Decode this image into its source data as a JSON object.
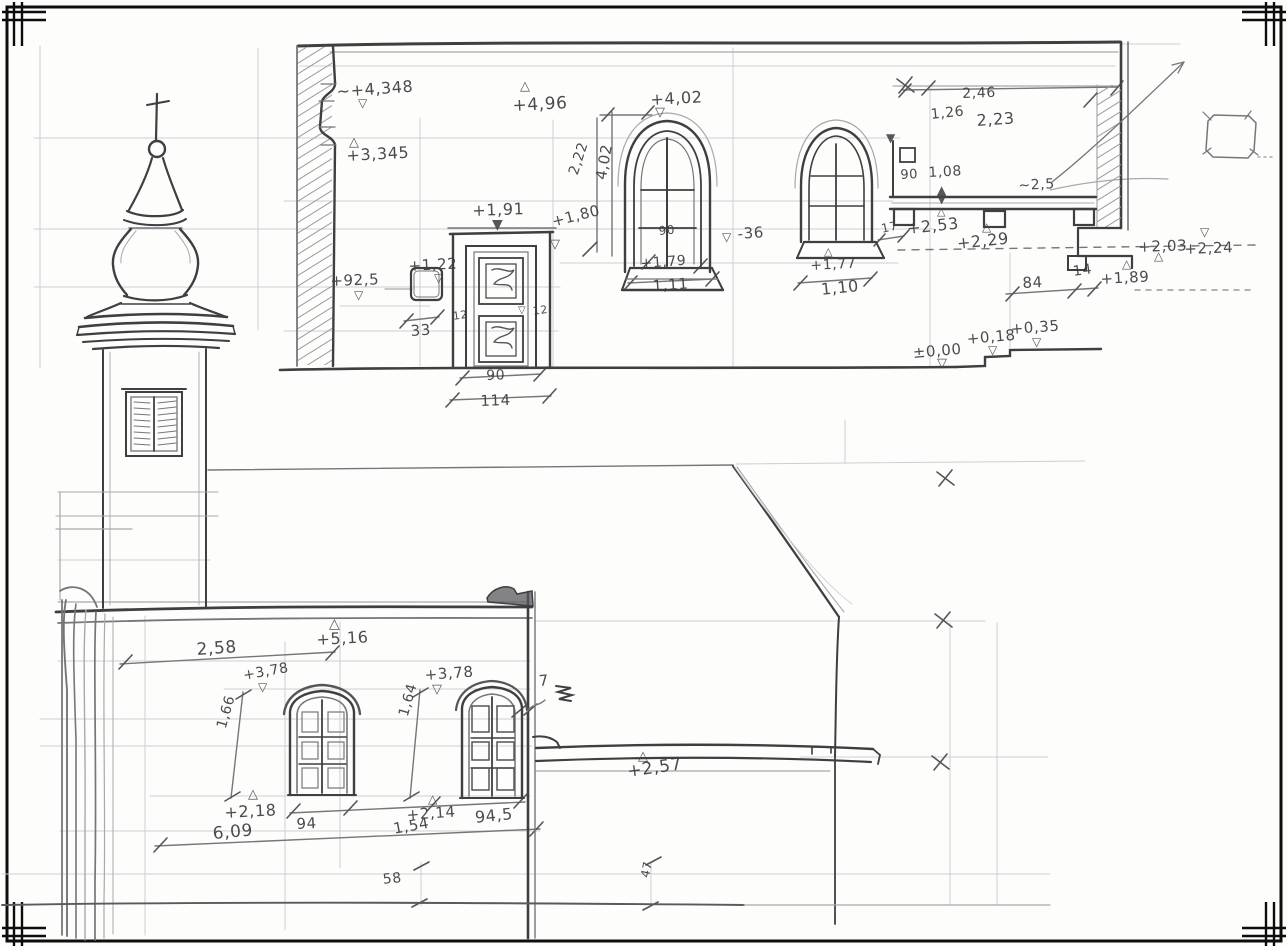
{
  "meta": {
    "sheet_type": "hand-drawn architectural survey field sketch",
    "subject": "church elevations: upper street facade with paneled door and two arched windows, baroque onion-dome tower, lower courtyard facade with two arched windows",
    "medium": "pencil on white paper",
    "paper_color": "#fdfdfc",
    "pencil_color": "#3f3f41",
    "marker_note": "triangles mark surveyed spot levels; values use comma decimals (metres) and plain centimetre figures"
  },
  "annotations": {
    "upper": [
      {
        "text": "~+4,348",
        "x": 336,
        "y": 82,
        "rot": -4,
        "fs": 16,
        "role": "level"
      },
      {
        "text": "+4,96",
        "x": 512,
        "y": 96,
        "rot": -3,
        "fs": 17,
        "role": "level"
      },
      {
        "text": "+3,345",
        "x": 346,
        "y": 146,
        "rot": -3,
        "fs": 16,
        "role": "level"
      },
      {
        "text": "+1,91",
        "x": 472,
        "y": 201,
        "rot": -2,
        "fs": 16,
        "role": "level"
      },
      {
        "text": "+1,80",
        "x": 550,
        "y": 213,
        "rot": -14,
        "fs": 15,
        "role": "level"
      },
      {
        "text": "2,22",
        "x": 566,
        "y": 172,
        "rot": -72,
        "fs": 14,
        "role": "dim"
      },
      {
        "text": "4,02",
        "x": 592,
        "y": 178,
        "rot": -80,
        "fs": 15,
        "role": "dim"
      },
      {
        "text": "+4,02",
        "x": 650,
        "y": 90,
        "rot": -3,
        "fs": 16,
        "role": "level"
      },
      {
        "text": "90",
        "x": 658,
        "y": 224,
        "rot": -5,
        "fs": 12,
        "role": "dim"
      },
      {
        "text": "+1,79",
        "x": 640,
        "y": 256,
        "rot": -4,
        "fs": 14,
        "role": "level"
      },
      {
        "text": "1,11",
        "x": 652,
        "y": 277,
        "rot": -4,
        "fs": 15,
        "role": "dim"
      },
      {
        "text": "-36",
        "x": 737,
        "y": 225,
        "rot": -4,
        "fs": 15,
        "role": "level"
      },
      {
        "text": "+1,77",
        "x": 810,
        "y": 258,
        "rot": -3,
        "fs": 14,
        "role": "level"
      },
      {
        "text": "1,10",
        "x": 820,
        "y": 280,
        "rot": -6,
        "fs": 16,
        "role": "dim"
      },
      {
        "text": "17",
        "x": 880,
        "y": 222,
        "rot": -12,
        "fs": 12,
        "role": "dim"
      },
      {
        "text": "2,46",
        "x": 962,
        "y": 86,
        "rot": -2,
        "fs": 14,
        "role": "dim"
      },
      {
        "text": "1,26",
        "x": 930,
        "y": 107,
        "rot": -6,
        "fs": 14,
        "role": "dim"
      },
      {
        "text": "2,23",
        "x": 976,
        "y": 111,
        "rot": -4,
        "fs": 16,
        "role": "dim"
      },
      {
        "text": "90",
        "x": 900,
        "y": 168,
        "rot": -3,
        "fs": 13,
        "role": "dim"
      },
      {
        "text": "1,08",
        "x": 928,
        "y": 165,
        "rot": -3,
        "fs": 14,
        "role": "dim"
      },
      {
        "text": "~2,5",
        "x": 1018,
        "y": 178,
        "rot": -3,
        "fs": 14,
        "role": "dim"
      },
      {
        "text": "+2,53",
        "x": 906,
        "y": 219,
        "rot": -6,
        "fs": 16,
        "role": "level"
      },
      {
        "text": "+2,29",
        "x": 956,
        "y": 234,
        "rot": -6,
        "fs": 16,
        "role": "level"
      },
      {
        "text": "84",
        "x": 1022,
        "y": 274,
        "rot": -3,
        "fs": 15,
        "role": "dim"
      },
      {
        "text": "14",
        "x": 1072,
        "y": 264,
        "rot": -8,
        "fs": 14,
        "role": "dim"
      },
      {
        "text": "+1,89",
        "x": 1100,
        "y": 270,
        "rot": -3,
        "fs": 15,
        "role": "level"
      },
      {
        "text": "+2,03",
        "x": 1138,
        "y": 238,
        "rot": -2,
        "fs": 15,
        "role": "level"
      },
      {
        "text": "+2,24",
        "x": 1184,
        "y": 240,
        "rot": -2,
        "fs": 15,
        "role": "level"
      },
      {
        "text": "±0,00",
        "x": 912,
        "y": 344,
        "rot": -5,
        "fs": 15,
        "role": "level"
      },
      {
        "text": "+0,18",
        "x": 966,
        "y": 330,
        "rot": -5,
        "fs": 15,
        "role": "level"
      },
      {
        "text": "+0,35",
        "x": 1010,
        "y": 320,
        "rot": -4,
        "fs": 15,
        "role": "level"
      },
      {
        "text": "+92,5",
        "x": 330,
        "y": 272,
        "rot": -2,
        "fs": 15,
        "role": "level"
      },
      {
        "text": "+1,22",
        "x": 408,
        "y": 257,
        "rot": -3,
        "fs": 15,
        "role": "level"
      },
      {
        "text": "33",
        "x": 410,
        "y": 322,
        "rot": -4,
        "fs": 15,
        "role": "dim"
      },
      {
        "text": "12",
        "x": 452,
        "y": 310,
        "rot": -8,
        "fs": 11,
        "role": "dim"
      },
      {
        "text": "12",
        "x": 532,
        "y": 305,
        "rot": -8,
        "fs": 11,
        "role": "dim"
      },
      {
        "text": "90",
        "x": 486,
        "y": 368,
        "rot": -2,
        "fs": 14,
        "role": "dim"
      },
      {
        "text": "114",
        "x": 480,
        "y": 392,
        "rot": -2,
        "fs": 15,
        "role": "dim"
      }
    ],
    "lower": [
      {
        "text": "+5,16",
        "x": 316,
        "y": 630,
        "rot": -3,
        "fs": 16,
        "role": "level"
      },
      {
        "text": "2,58",
        "x": 196,
        "y": 640,
        "rot": -4,
        "fs": 17,
        "role": "dim"
      },
      {
        "text": "+3,78",
        "x": 242,
        "y": 668,
        "rot": -10,
        "fs": 14,
        "role": "level"
      },
      {
        "text": "1,66",
        "x": 214,
        "y": 726,
        "rot": -74,
        "fs": 14,
        "role": "dim"
      },
      {
        "text": "+2,18",
        "x": 224,
        "y": 803,
        "rot": -3,
        "fs": 16,
        "role": "level"
      },
      {
        "text": "94",
        "x": 296,
        "y": 815,
        "rot": -3,
        "fs": 15,
        "role": "dim"
      },
      {
        "text": "6,09",
        "x": 212,
        "y": 824,
        "rot": -5,
        "fs": 17,
        "role": "dim"
      },
      {
        "text": "+3,78",
        "x": 424,
        "y": 666,
        "rot": -4,
        "fs": 15,
        "role": "level"
      },
      {
        "text": "1,64",
        "x": 396,
        "y": 714,
        "rot": -74,
        "fs": 14,
        "role": "dim"
      },
      {
        "text": "7",
        "x": 538,
        "y": 672,
        "rot": -5,
        "fs": 15,
        "role": "dim"
      },
      {
        "text": "+2,14",
        "x": 406,
        "y": 806,
        "rot": -4,
        "fs": 15,
        "role": "level"
      },
      {
        "text": "1,54",
        "x": 392,
        "y": 820,
        "rot": -10,
        "fs": 15,
        "role": "dim"
      },
      {
        "text": "94,5",
        "x": 474,
        "y": 808,
        "rot": -6,
        "fs": 16,
        "role": "dim"
      },
      {
        "text": "+2,57",
        "x": 626,
        "y": 762,
        "rot": -8,
        "fs": 17,
        "role": "level"
      },
      {
        "text": "58",
        "x": 382,
        "y": 872,
        "rot": -6,
        "fs": 14,
        "role": "dim"
      },
      {
        "text": "47",
        "x": 638,
        "y": 876,
        "rot": -78,
        "fs": 12,
        "role": "dim"
      }
    ],
    "markers": [
      {
        "glyph": "▽",
        "x": 358,
        "y": 97,
        "fs": 12
      },
      {
        "glyph": "△",
        "x": 520,
        "y": 80,
        "fs": 13
      },
      {
        "glyph": "△",
        "x": 349,
        "y": 136,
        "fs": 13
      },
      {
        "glyph": "▼",
        "x": 492,
        "y": 218,
        "fs": 14
      },
      {
        "glyph": "▽",
        "x": 550,
        "y": 238,
        "fs": 13
      },
      {
        "glyph": "▽",
        "x": 655,
        "y": 106,
        "fs": 13
      },
      {
        "glyph": "▽",
        "x": 722,
        "y": 231,
        "fs": 12
      },
      {
        "glyph": "△",
        "x": 824,
        "y": 246,
        "fs": 11
      },
      {
        "glyph": "▼",
        "x": 886,
        "y": 132,
        "fs": 12
      },
      {
        "glyph": "▲",
        "x": 937,
        "y": 184,
        "fs": 12
      },
      {
        "glyph": "▼",
        "x": 937,
        "y": 193,
        "fs": 12
      },
      {
        "glyph": "△",
        "x": 937,
        "y": 206,
        "fs": 11
      },
      {
        "glyph": "△",
        "x": 982,
        "y": 221,
        "fs": 12
      },
      {
        "glyph": "△",
        "x": 1122,
        "y": 258,
        "fs": 12
      },
      {
        "glyph": "△",
        "x": 1154,
        "y": 250,
        "fs": 12
      },
      {
        "glyph": "▽",
        "x": 1200,
        "y": 226,
        "fs": 12
      },
      {
        "glyph": "▽",
        "x": 937,
        "y": 357,
        "fs": 13
      },
      {
        "glyph": "▽",
        "x": 988,
        "y": 344,
        "fs": 12
      },
      {
        "glyph": "▽",
        "x": 1032,
        "y": 336,
        "fs": 12
      },
      {
        "glyph": "▽",
        "x": 354,
        "y": 289,
        "fs": 12
      },
      {
        "glyph": "▽",
        "x": 434,
        "y": 272,
        "fs": 12
      },
      {
        "glyph": "▽",
        "x": 518,
        "y": 306,
        "fs": 10
      },
      {
        "glyph": "△",
        "x": 329,
        "y": 617,
        "fs": 14
      },
      {
        "glyph": "▽",
        "x": 258,
        "y": 681,
        "fs": 12
      },
      {
        "glyph": "▽",
        "x": 432,
        "y": 683,
        "fs": 13
      },
      {
        "glyph": "△",
        "x": 248,
        "y": 788,
        "fs": 13
      },
      {
        "glyph": "△",
        "x": 428,
        "y": 793,
        "fs": 12
      },
      {
        "glyph": "△",
        "x": 638,
        "y": 750,
        "fs": 13
      }
    ]
  }
}
